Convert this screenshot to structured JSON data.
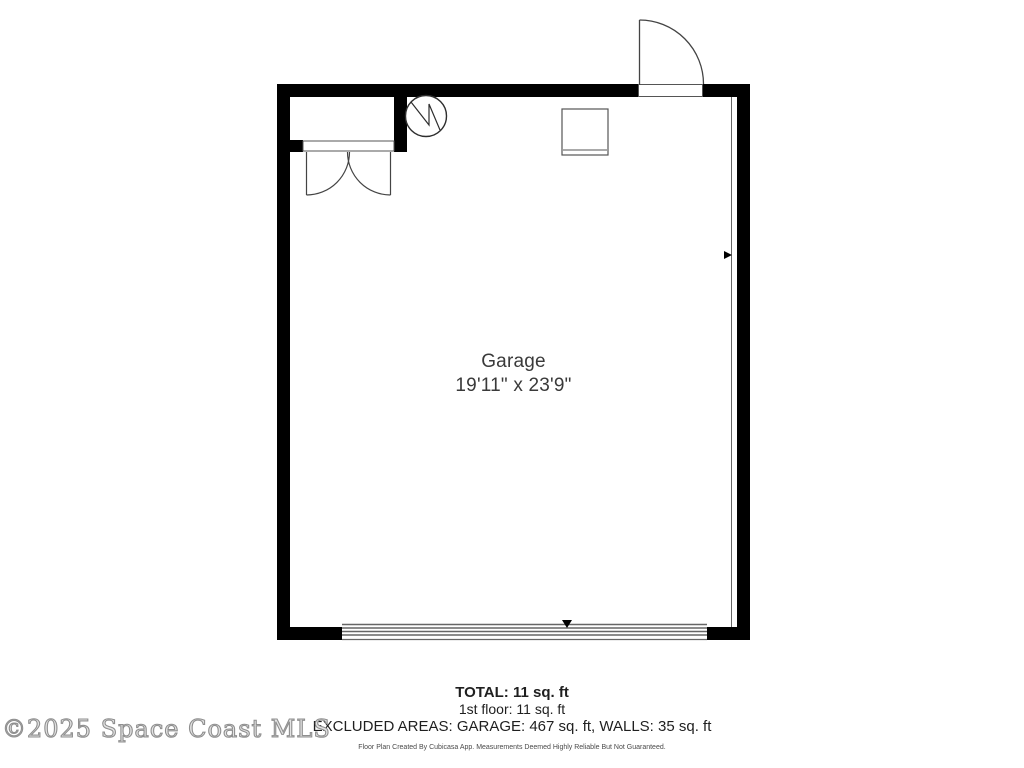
{
  "plan": {
    "room_label": "Garage",
    "room_dimensions": "19'11\" x 23'9\"",
    "symbols": [
      "water-heater-icon",
      "appliance-box",
      "closet-double-door",
      "entry-door-swing",
      "garage-door",
      "measurement-arrows"
    ]
  },
  "summary": {
    "total": "TOTAL: 11 sq. ft",
    "first_floor": "1st floor: 11 sq. ft",
    "excluded_areas": "EXCLUDED AREAS: GARAGE: 467 sq. ft, WALLS: 35 sq. ft",
    "disclaimer": "Floor Plan Created By Cubicasa App. Measurements Deemed Highly Reliable But Not Guaranteed."
  },
  "watermark": "©2025 Space Coast MLS",
  "colors": {
    "wall": "#000000",
    "symbol_line": "#4d4d4d",
    "label_text": "#3a3a3a",
    "summary_text": "#1f1f1f",
    "watermark": "#8f8f8f",
    "background": "#ffffff"
  }
}
